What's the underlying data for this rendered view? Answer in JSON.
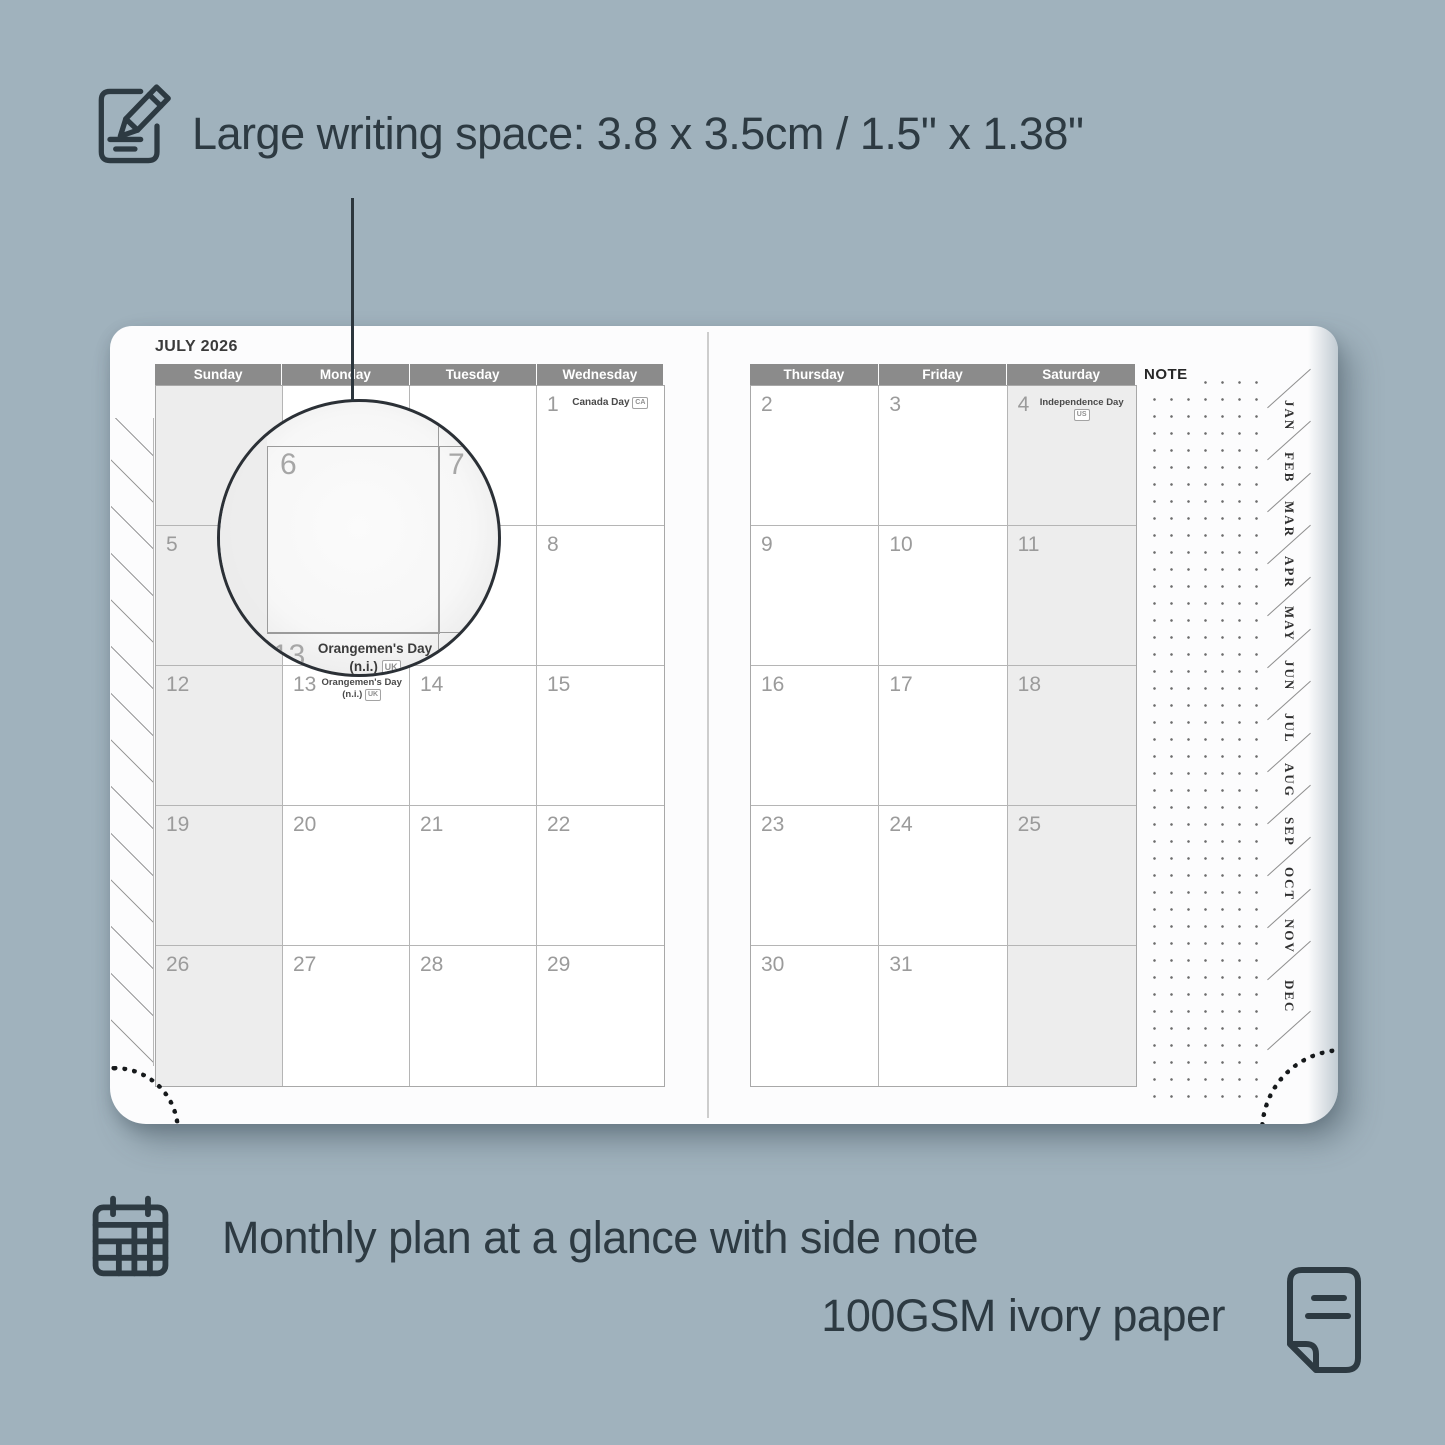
{
  "colors": {
    "background": "#a0b2bd",
    "annotation_text": "#2d3a42",
    "page_white": "#fcfcfd",
    "header_bar": "#8b8b8b",
    "header_text": "#ffffff",
    "date_number": "#9b9b9b",
    "cell_border": "#b5b5b5",
    "weekend_shade": "#ededed"
  },
  "icons": {
    "top_left": "pencil-writing-icon",
    "bottom_left": "calendar-grid-icon",
    "bottom_right": "paper-sheet-icon"
  },
  "top_annotation": {
    "text": "Large writing space: 3.8 x 3.5cm / 1.5\" x 1.38\""
  },
  "bottom_annotation": {
    "line1": "Monthly plan at a glance with side note",
    "line2": "100GSM ivory paper"
  },
  "planner": {
    "title": "JULY 2026",
    "note_label": "NOTE",
    "left_day_headers": [
      "Sunday",
      "Monday",
      "Tuesday",
      "Wednesday"
    ],
    "right_day_headers": [
      "Thursday",
      "Friday",
      "Saturday"
    ],
    "month_tabs": [
      "JAN",
      "FEB",
      "MAR",
      "APR",
      "MAY",
      "JUN",
      "JUL",
      "AUG",
      "SEP",
      "OCT",
      "NOV",
      "DEC"
    ],
    "left_cells": [
      {
        "day": ""
      },
      {
        "day": ""
      },
      {
        "day": ""
      },
      {
        "day": "1",
        "holiday": {
          "line1": "Canada Day",
          "badge": "CA"
        }
      },
      {
        "day": "5"
      },
      {
        "day": "6"
      },
      {
        "day": "7"
      },
      {
        "day": "8"
      },
      {
        "day": "12"
      },
      {
        "day": "13",
        "holiday": {
          "line1": "Orangemen's Day",
          "line2": "(n.i.)",
          "badge": "UK"
        }
      },
      {
        "day": "14"
      },
      {
        "day": "15"
      },
      {
        "day": "19"
      },
      {
        "day": "20"
      },
      {
        "day": "21"
      },
      {
        "day": "22"
      },
      {
        "day": "26"
      },
      {
        "day": "27"
      },
      {
        "day": "28"
      },
      {
        "day": "29"
      }
    ],
    "right_cells": [
      {
        "day": "2"
      },
      {
        "day": "3"
      },
      {
        "day": "4",
        "holiday": {
          "line1": "Independence Day",
          "badge": "US"
        }
      },
      {
        "day": "9"
      },
      {
        "day": "10"
      },
      {
        "day": "11"
      },
      {
        "day": "16"
      },
      {
        "day": "17"
      },
      {
        "day": "18"
      },
      {
        "day": "23"
      },
      {
        "day": "24"
      },
      {
        "day": "25"
      },
      {
        "day": "30"
      },
      {
        "day": "31"
      },
      {
        "day": ""
      }
    ]
  },
  "magnifier": {
    "cell_day": "6",
    "next_day": "7",
    "bottom_day": "13",
    "holiday_line1": "Orangemen's Day",
    "holiday_line2": "(n.i.)",
    "holiday_badge": "UK"
  }
}
